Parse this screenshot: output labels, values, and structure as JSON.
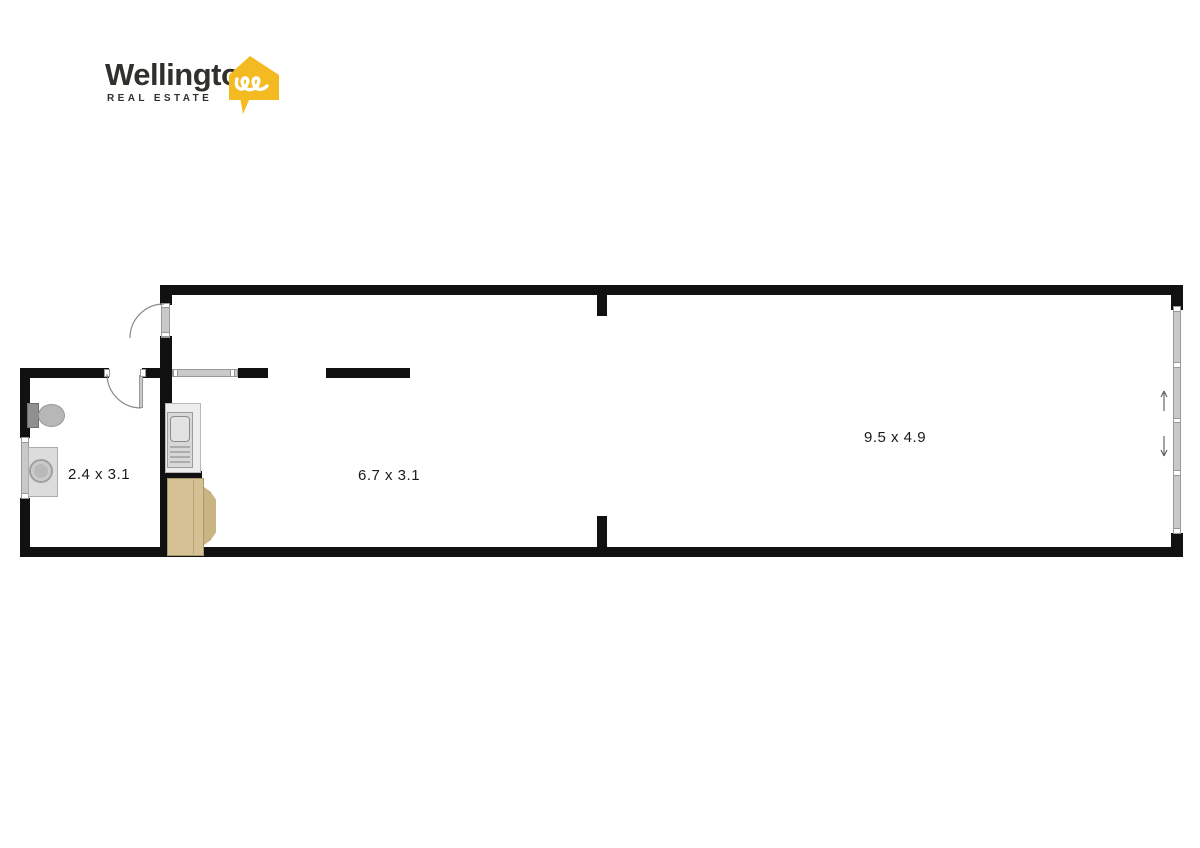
{
  "brand": {
    "name": "Wellington",
    "tagline": "REAL ESTATE",
    "logo_icon": "wellington-house-speech-bubble-icon"
  },
  "colors": {
    "brand_yellow": "#F3BA22",
    "brand_dark": "#32302C",
    "wall": "#111111",
    "window_gray": "#c9c9c9",
    "furniture_tan": "#d5c294",
    "appliance_gray": "#d8d8d8",
    "label_color": "#1a1a1a"
  },
  "rooms": [
    {
      "name": "bathroom-laundry",
      "dimensions": "2.4 x 3.1"
    },
    {
      "name": "kitchen-living",
      "dimensions": "6.7 x 3.1"
    },
    {
      "name": "main-room",
      "dimensions": "9.5 x 4.9"
    }
  ],
  "fixtures": [
    "toilet",
    "washing-machine",
    "kitchen-sink-unit",
    "sofa",
    "entry-door-swing",
    "bathroom-door-swing",
    "sliding-window-wall"
  ]
}
